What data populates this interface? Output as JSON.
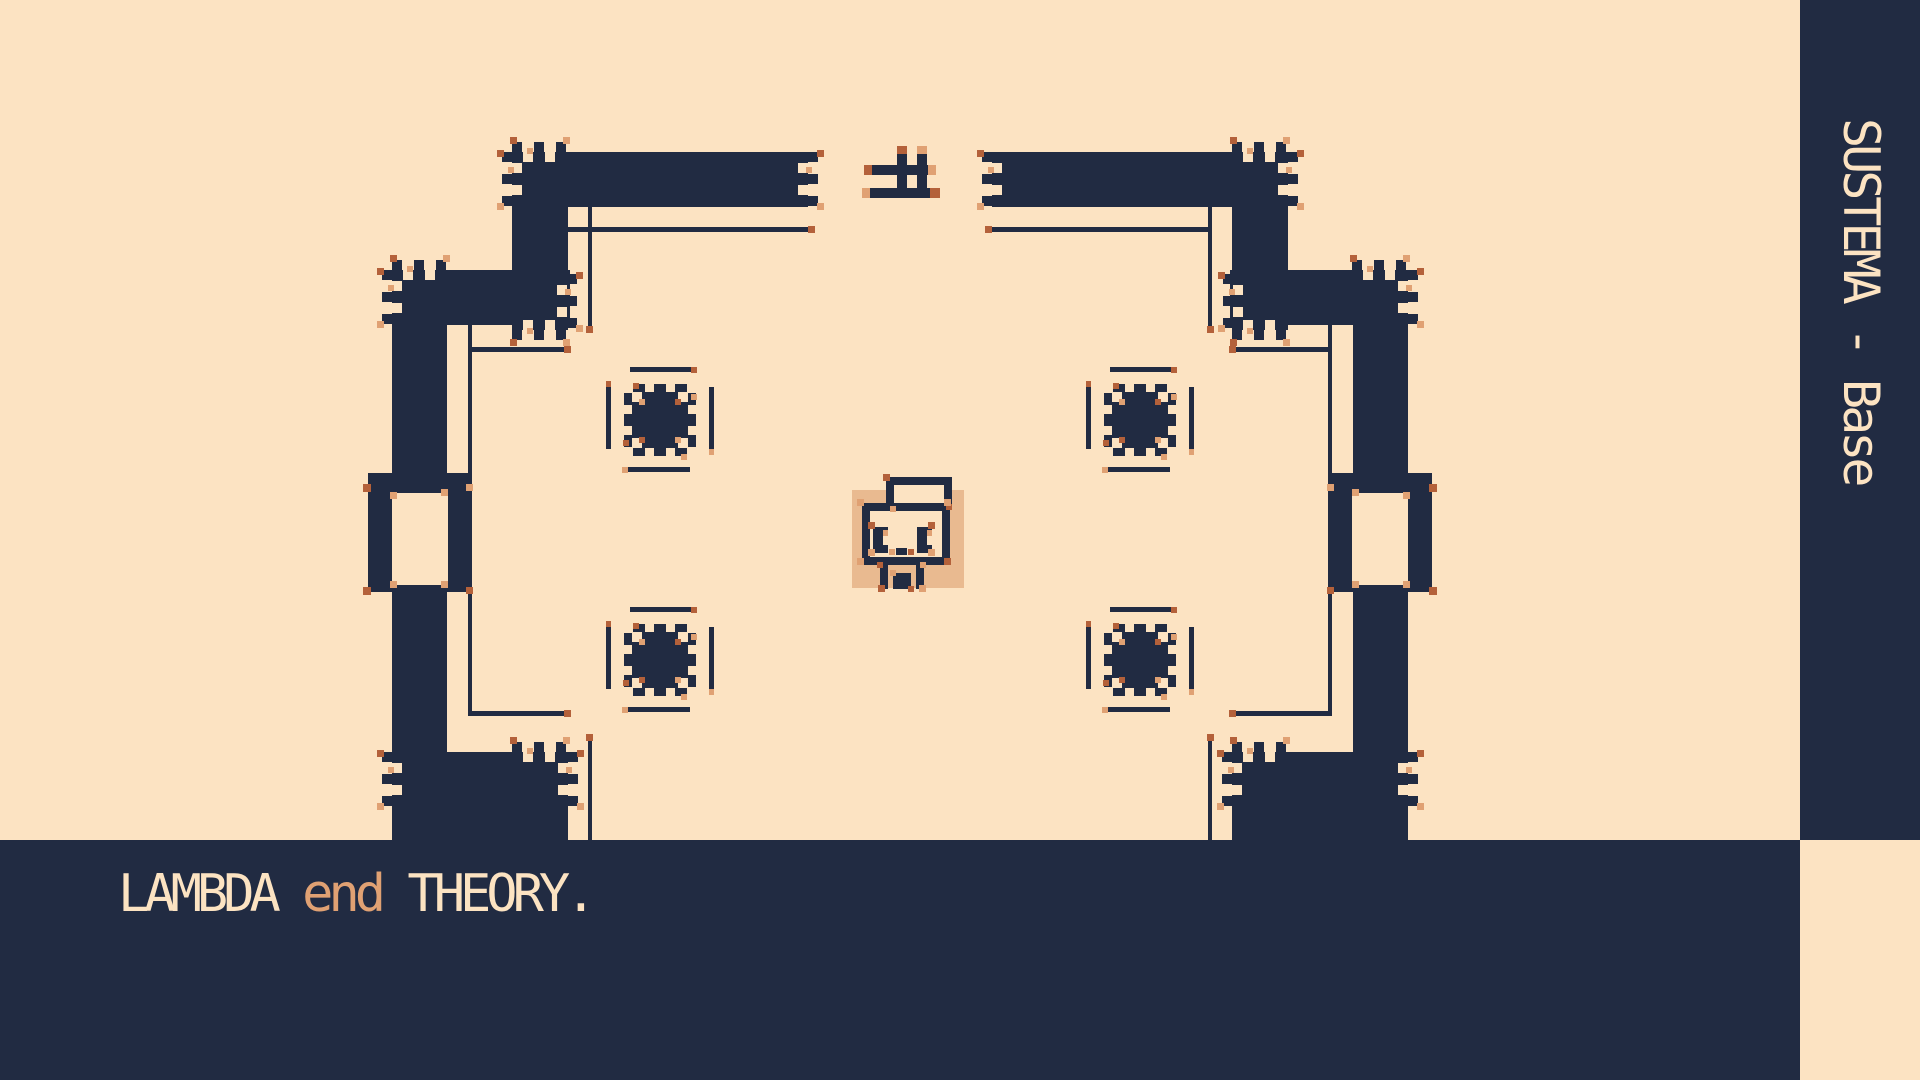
{
  "palette": {
    "cream": "#fce3c2",
    "ink": "#212b42",
    "accent": "#b4613a",
    "accent_light": "#e0a173",
    "tan": "#e9ba90"
  },
  "sidebar": {
    "label": "SUSTEMA - Base"
  },
  "caption": {
    "parts": [
      {
        "text": "LAMBDA ",
        "color": "cream"
      },
      {
        "text": "end",
        "color": "accent_light"
      },
      {
        "text": " THEORY.",
        "color": "cream"
      }
    ]
  },
  "scene": {
    "size": [
      1920,
      1080
    ],
    "chrome": {
      "sidebar": [
        1800,
        0,
        120,
        840
      ],
      "band": [
        0,
        840,
        1800,
        240
      ],
      "corner": [
        1800,
        840,
        120,
        240
      ]
    },
    "walls": [
      [
        512,
        152,
        296,
        55
      ],
      [
        992,
        152,
        296,
        55
      ],
      [
        512,
        152,
        56,
        178
      ],
      [
        1232,
        152,
        56,
        178
      ],
      [
        392,
        270,
        178,
        55
      ],
      [
        1230,
        270,
        178,
        55
      ],
      [
        392,
        325,
        55,
        148
      ],
      [
        1353,
        325,
        55,
        148
      ],
      [
        368,
        473,
        104,
        119
      ],
      [
        1328,
        473,
        104,
        119
      ],
      [
        392,
        592,
        55,
        160
      ],
      [
        1353,
        592,
        55,
        160
      ],
      [
        392,
        752,
        176,
        88
      ],
      [
        1232,
        752,
        176,
        88
      ]
    ],
    "cutouts": [
      [
        392,
        493,
        56,
        92
      ],
      [
        1352,
        493,
        56,
        92
      ]
    ],
    "lines": [
      [
        568,
        227,
        240,
        5
      ],
      [
        992,
        227,
        220,
        5
      ],
      [
        588,
        207,
        4,
        123
      ],
      [
        1208,
        207,
        4,
        123
      ],
      [
        472,
        347,
        98,
        5
      ],
      [
        1230,
        347,
        98,
        5
      ],
      [
        468,
        325,
        4,
        148
      ],
      [
        1328,
        325,
        4,
        148
      ],
      [
        468,
        592,
        4,
        123
      ],
      [
        1328,
        592,
        4,
        123
      ],
      [
        468,
        711,
        102,
        5
      ],
      [
        1230,
        711,
        102,
        5
      ],
      [
        588,
        737,
        4,
        103
      ],
      [
        1208,
        737,
        4,
        103
      ]
    ],
    "teeth": [
      {
        "x": 512,
        "y": 152,
        "dir": "left"
      },
      {
        "x": 512,
        "y": 152,
        "dir": "up"
      },
      {
        "x": 808,
        "y": 152,
        "dir": "right"
      },
      {
        "x": 992,
        "y": 152,
        "dir": "left"
      },
      {
        "x": 1288,
        "y": 152,
        "dir": "right"
      },
      {
        "x": 1232,
        "y": 152,
        "dir": "up"
      },
      {
        "x": 392,
        "y": 270,
        "dir": "left"
      },
      {
        "x": 392,
        "y": 270,
        "dir": "up"
      },
      {
        "x": 1408,
        "y": 270,
        "dir": "right"
      },
      {
        "x": 1352,
        "y": 270,
        "dir": "up"
      },
      {
        "x": 567,
        "y": 274,
        "dir": "right"
      },
      {
        "x": 1233,
        "y": 274,
        "dir": "left"
      },
      {
        "x": 512,
        "y": 330,
        "dir": "down"
      },
      {
        "x": 1232,
        "y": 330,
        "dir": "down"
      },
      {
        "x": 392,
        "y": 752,
        "dir": "left"
      },
      {
        "x": 512,
        "y": 752,
        "dir": "up"
      },
      {
        "x": 568,
        "y": 752,
        "dir": "right"
      },
      {
        "x": 1232,
        "y": 752,
        "dir": "up"
      },
      {
        "x": 1232,
        "y": 752,
        "dir": "left"
      },
      {
        "x": 1408,
        "y": 752,
        "dir": "right"
      }
    ],
    "accents": [
      [
        808,
        226,
        7,
        7,
        "a"
      ],
      [
        985,
        226,
        7,
        7,
        "a"
      ],
      [
        586,
        326,
        7,
        7,
        "a"
      ],
      [
        1207,
        326,
        7,
        7,
        "a"
      ],
      [
        564,
        346,
        7,
        7,
        "a"
      ],
      [
        1229,
        346,
        7,
        7,
        "a"
      ],
      [
        564,
        710,
        7,
        7,
        "a"
      ],
      [
        1229,
        710,
        7,
        7,
        "a"
      ],
      [
        586,
        734,
        7,
        7,
        "a"
      ],
      [
        1207,
        734,
        7,
        7,
        "a"
      ],
      [
        363,
        484,
        8,
        8,
        "a"
      ],
      [
        390,
        492,
        7,
        7,
        "l"
      ],
      [
        441,
        489,
        7,
        7,
        "l"
      ],
      [
        363,
        587,
        8,
        8,
        "a"
      ],
      [
        390,
        581,
        7,
        7,
        "l"
      ],
      [
        441,
        581,
        7,
        7,
        "l"
      ],
      [
        466,
        484,
        7,
        7,
        "l"
      ],
      [
        466,
        587,
        7,
        7,
        "a"
      ],
      [
        1429,
        484,
        8,
        8,
        "a"
      ],
      [
        1403,
        492,
        7,
        7,
        "l"
      ],
      [
        1352,
        489,
        7,
        7,
        "l"
      ],
      [
        1429,
        587,
        8,
        8,
        "a"
      ],
      [
        1403,
        581,
        7,
        7,
        "l"
      ],
      [
        1352,
        581,
        7,
        7,
        "l"
      ],
      [
        1327,
        484,
        7,
        7,
        "l"
      ],
      [
        1327,
        587,
        7,
        7,
        "a"
      ]
    ],
    "flower": {
      "positions": [
        [
          606,
          367
        ],
        [
          606,
          607
        ],
        [
          1086,
          367
        ],
        [
          1086,
          607
        ]
      ],
      "lines": [
        [
          24,
          0,
          62,
          5
        ],
        [
          22,
          100,
          62,
          5
        ],
        [
          0,
          20,
          5,
          62
        ],
        [
          103,
          20,
          5,
          62
        ]
      ],
      "core": {
        "x": 26,
        "y": 25,
        "s": 56
      },
      "bump_offsets": [
        1,
        22,
        43
      ],
      "bump": {
        "w": 12,
        "out": 8
      },
      "notch": 10,
      "accents": [
        [
          85,
          0,
          6,
          6,
          "a"
        ],
        [
          16,
          100,
          6,
          6,
          "l"
        ],
        [
          0,
          14,
          5,
          6,
          "a"
        ],
        [
          103,
          82,
          5,
          6,
          "l"
        ],
        [
          33,
          32,
          6,
          6,
          "l"
        ],
        [
          69,
          32,
          6,
          6,
          "a"
        ],
        [
          33,
          70,
          6,
          6,
          "a"
        ],
        [
          69,
          70,
          6,
          6,
          "l"
        ],
        [
          27,
          16,
          6,
          6,
          "a"
        ],
        [
          75,
          87,
          6,
          6,
          "l"
        ],
        [
          17,
          73,
          6,
          6,
          "a"
        ],
        [
          85,
          27,
          6,
          6,
          "l"
        ]
      ]
    },
    "gate": [
      [
        897,
        146,
        10,
        8,
        "a"
      ],
      [
        917,
        146,
        10,
        8,
        "l"
      ],
      [
        897,
        154,
        10,
        44,
        "i"
      ],
      [
        917,
        154,
        10,
        44,
        "i"
      ],
      [
        864,
        165,
        8,
        10,
        "a"
      ],
      [
        872,
        165,
        56,
        10,
        "i"
      ],
      [
        928,
        165,
        8,
        10,
        "l"
      ],
      [
        862,
        188,
        8,
        10,
        "l"
      ],
      [
        870,
        188,
        60,
        10,
        "i"
      ],
      [
        930,
        188,
        10,
        10,
        "a"
      ]
    ],
    "character": [
      [
        852,
        490,
        112,
        98,
        "t"
      ],
      [
        862,
        503,
        88,
        62,
        "i"
      ],
      [
        870,
        511,
        72,
        46,
        "c"
      ],
      [
        886,
        477,
        8,
        34,
        "i"
      ],
      [
        886,
        477,
        66,
        8,
        "i"
      ],
      [
        944,
        477,
        8,
        32,
        "i"
      ],
      [
        894,
        485,
        50,
        18,
        "c"
      ],
      [
        883,
        474,
        7,
        7,
        "a"
      ],
      [
        946,
        504,
        6,
        6,
        "a"
      ],
      [
        890,
        506,
        6,
        6,
        "l"
      ],
      [
        857,
        499,
        7,
        7,
        "l"
      ],
      [
        944,
        499,
        7,
        7,
        "l"
      ],
      [
        857,
        558,
        7,
        7,
        "l"
      ],
      [
        944,
        558,
        7,
        7,
        "a"
      ],
      [
        873,
        527,
        15,
        26,
        "i"
      ],
      [
        917,
        527,
        15,
        26,
        "i"
      ],
      [
        883,
        536,
        5,
        9,
        "c"
      ],
      [
        927,
        536,
        5,
        9,
        "c"
      ],
      [
        883,
        530,
        5,
        6,
        "l"
      ],
      [
        927,
        530,
        5,
        6,
        "l"
      ],
      [
        868,
        522,
        7,
        7,
        "a"
      ],
      [
        868,
        549,
        7,
        7,
        "l"
      ],
      [
        928,
        522,
        7,
        7,
        "a"
      ],
      [
        928,
        549,
        7,
        7,
        "l"
      ],
      [
        896,
        548,
        11,
        7,
        "i"
      ],
      [
        889,
        549,
        6,
        6,
        "l"
      ],
      [
        908,
        549,
        6,
        6,
        "a"
      ],
      [
        880,
        565,
        8,
        24,
        "i"
      ],
      [
        916,
        565,
        8,
        24,
        "i"
      ],
      [
        893,
        573,
        18,
        16,
        "i"
      ],
      [
        877,
        562,
        6,
        6,
        "a"
      ],
      [
        920,
        562,
        6,
        6,
        "l"
      ],
      [
        878,
        585,
        7,
        7,
        "a"
      ],
      [
        919,
        585,
        7,
        7,
        "l"
      ],
      [
        890,
        570,
        6,
        6,
        "l"
      ],
      [
        908,
        586,
        6,
        6,
        "a"
      ]
    ]
  }
}
